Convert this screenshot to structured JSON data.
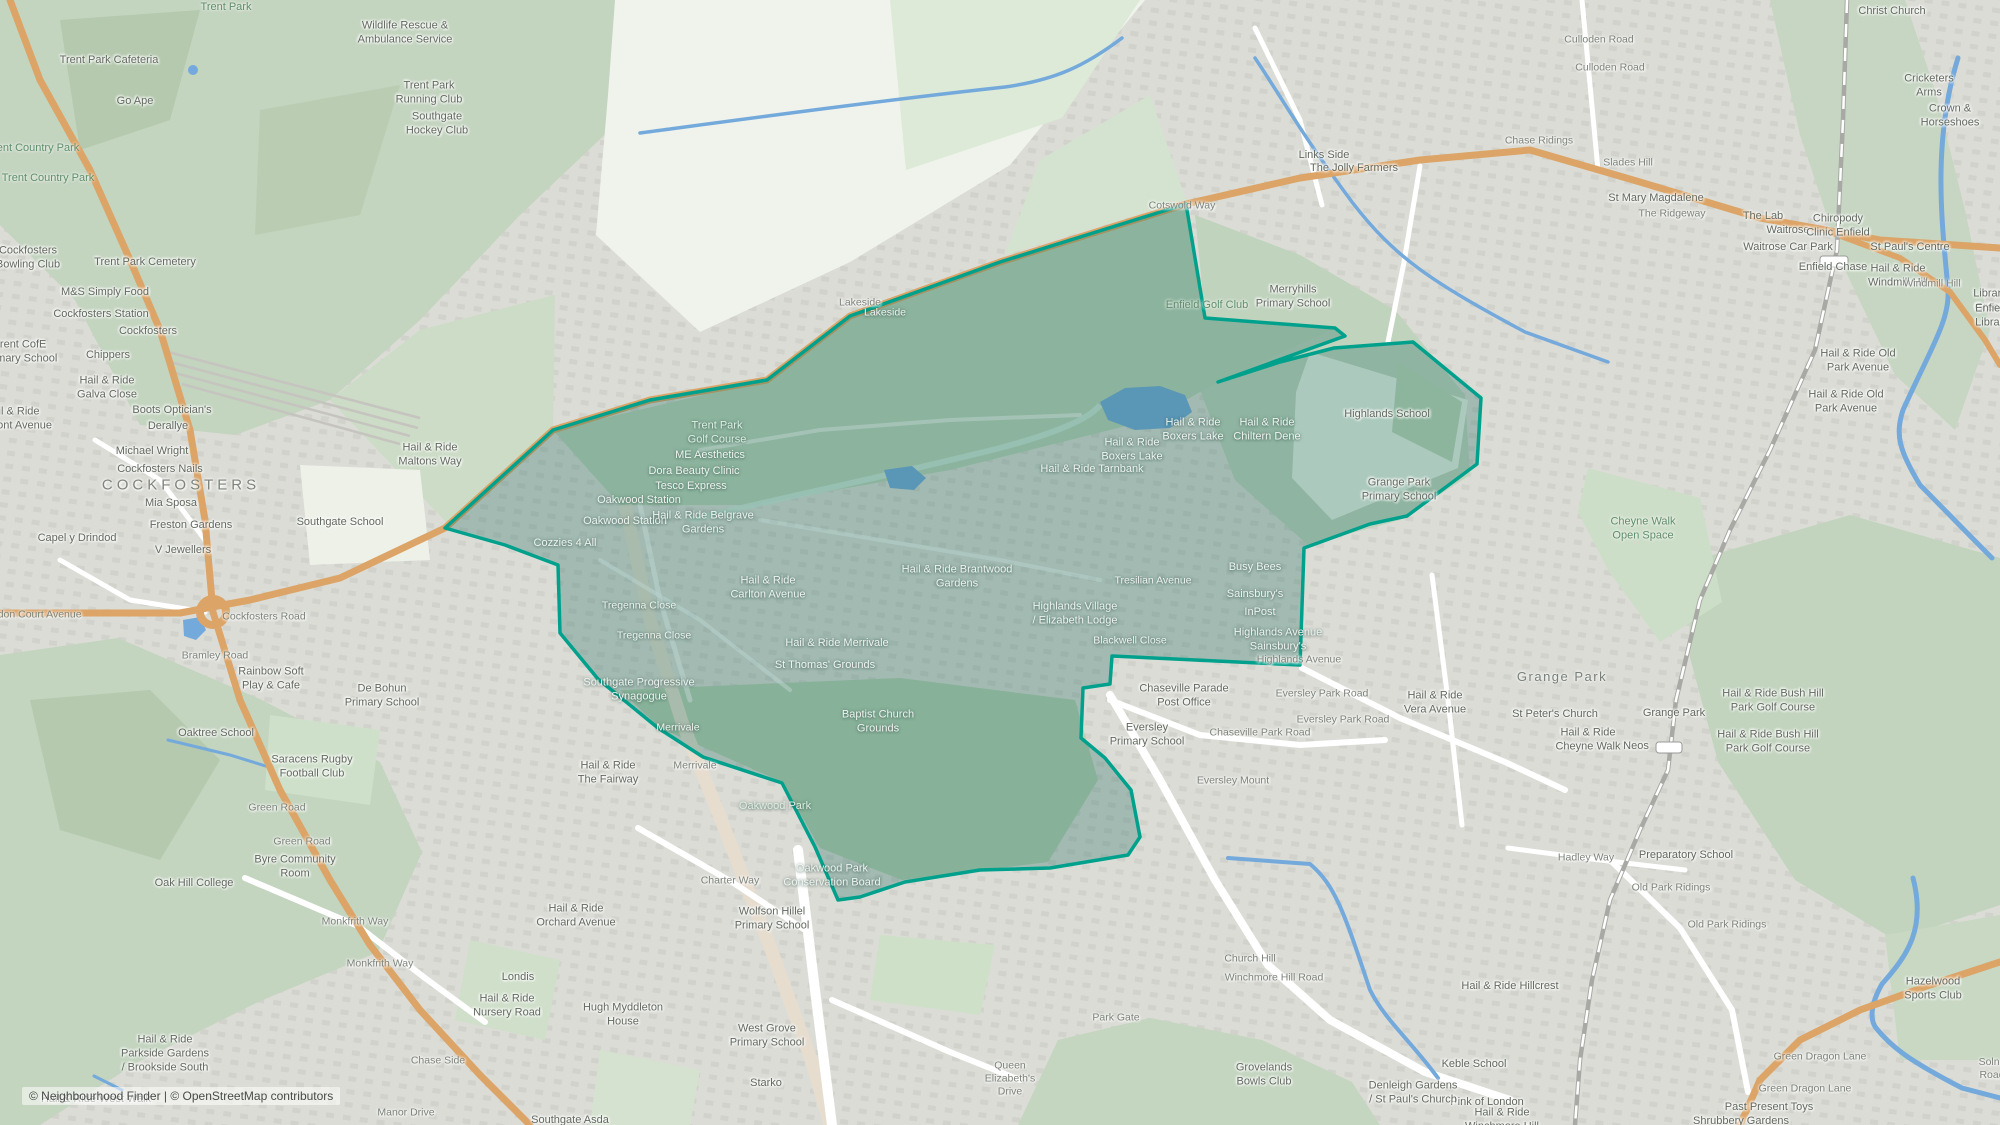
{
  "meta": {
    "width": 2000,
    "height": 1125,
    "attribution": "© Neighbourhood Finder | © OpenStreetMap contributors"
  },
  "colors": {
    "boundary_stroke": "#00a18c",
    "boundary_fill": "rgba(30,110,95,0.30)",
    "residential": "#dbdcd6",
    "park_green": "#c3d4bf",
    "field_light": "#f0f3ec",
    "water_blue": "#74a9dc",
    "road_orange": "#dca466",
    "rail_gray": "#a8a8a4"
  },
  "boundary": {
    "name": "highlighted-neighbourhood-boundary",
    "points": "1186,204 1205,318 1335,328 1345,336 1218,382 1280,362 1334,348 1413,342 1481,398 1477,464 1407,516 1370,524 1304,548 1300,665 1112,656 1110,684 1083,688 1081,738 1105,758 1131,790 1140,837 1128,855 1050,868 980,870 905,882 860,897 838,900 815,847 782,783 703,757 658,728 598,679 560,633 558,565 505,545 445,528 553,430 650,400 767,380 850,316 1000,262"
  },
  "labels": [
    {
      "t": "Trent Park",
      "x": 226,
      "y": 8,
      "c": "k"
    },
    {
      "t": "Wildlife Rescue &\nAmbulance Service",
      "x": 405,
      "y": 33,
      "c": "p"
    },
    {
      "t": "Trent Park Cafeteria",
      "x": 109,
      "y": 61,
      "c": "p"
    },
    {
      "t": "Go Ape",
      "x": 135,
      "y": 102,
      "c": "p"
    },
    {
      "t": "Trent Park\nRunning Club",
      "x": 429,
      "y": 93,
      "c": "p"
    },
    {
      "t": "Southgate\nHockey Club",
      "x": 437,
      "y": 124,
      "c": "p"
    },
    {
      "t": "Trent Country Park",
      "x": 33,
      "y": 149,
      "c": "k"
    },
    {
      "t": "Trent Country Park",
      "x": 48,
      "y": 179,
      "c": "k"
    },
    {
      "t": "Cockfosters\nBowling Club",
      "x": 28,
      "y": 258,
      "c": "p"
    },
    {
      "t": "Trent Park Cemetery",
      "x": 145,
      "y": 263,
      "c": "p"
    },
    {
      "t": "M&S Simply Food",
      "x": 105,
      "y": 293,
      "c": "p"
    },
    {
      "t": "Cockfosters Station",
      "x": 101,
      "y": 315,
      "c": "p"
    },
    {
      "t": "Cockfosters",
      "x": 148,
      "y": 332,
      "c": "p"
    },
    {
      "t": "Trent CofE\nPrimary School",
      "x": 20,
      "y": 352,
      "c": "p"
    },
    {
      "t": "Chippers",
      "x": 108,
      "y": 356,
      "c": "p"
    },
    {
      "t": "Hail & Ride\nGalva Close",
      "x": 107,
      "y": 388,
      "c": "p"
    },
    {
      "t": "Hail & Ride\nBelmont Avenue",
      "x": 12,
      "y": 419,
      "c": "p"
    },
    {
      "t": "Boots Optician's",
      "x": 172,
      "y": 411,
      "c": "p"
    },
    {
      "t": "Derallye",
      "x": 168,
      "y": 427,
      "c": "p"
    },
    {
      "t": "Michael Wright",
      "x": 152,
      "y": 452,
      "c": "p"
    },
    {
      "t": "Cockfosters Nails",
      "x": 160,
      "y": 470,
      "c": "p"
    },
    {
      "t": "COCKFOSTERS",
      "x": 181,
      "y": 486,
      "c": "a"
    },
    {
      "t": "Mia Sposa",
      "x": 171,
      "y": 504,
      "c": "p"
    },
    {
      "t": "Freston Gardens",
      "x": 191,
      "y": 526,
      "c": "p"
    },
    {
      "t": "Capel y Drindod",
      "x": 77,
      "y": 539,
      "c": "p"
    },
    {
      "t": "V Jewellers",
      "x": 183,
      "y": 551,
      "c": "p"
    },
    {
      "t": "Heddon Court Avenue",
      "x": 30,
      "y": 615,
      "c": "r"
    },
    {
      "t": "Cockfosters Road",
      "x": 264,
      "y": 617,
      "c": "r"
    },
    {
      "t": "Bramley Road",
      "x": 215,
      "y": 656,
      "c": "r"
    },
    {
      "t": "Rainbow Soft\nPlay & Cafe",
      "x": 271,
      "y": 679,
      "c": "p"
    },
    {
      "t": "Southgate School",
      "x": 340,
      "y": 523,
      "c": "p"
    },
    {
      "t": "De Bohun\nPrimary School",
      "x": 382,
      "y": 696,
      "c": "p"
    },
    {
      "t": "Oaktree School",
      "x": 216,
      "y": 734,
      "c": "p"
    },
    {
      "t": "Saracens Rugby\nFootball Club",
      "x": 312,
      "y": 767,
      "c": "p"
    },
    {
      "t": "Green Road",
      "x": 277,
      "y": 808,
      "c": "r"
    },
    {
      "t": "Green Road",
      "x": 302,
      "y": 842,
      "c": "r"
    },
    {
      "t": "Byre Community\nRoom",
      "x": 295,
      "y": 867,
      "c": "p"
    },
    {
      "t": "Oak Hill College",
      "x": 194,
      "y": 884,
      "c": "p"
    },
    {
      "t": "Monkfrith Way",
      "x": 355,
      "y": 922,
      "c": "r"
    },
    {
      "t": "Monkfrith Way",
      "x": 380,
      "y": 964,
      "c": "r"
    },
    {
      "t": "Londis",
      "x": 518,
      "y": 978,
      "c": "p"
    },
    {
      "t": "Hail & Ride\nNursery Road",
      "x": 507,
      "y": 1006,
      "c": "p"
    },
    {
      "t": "Chase Side",
      "x": 438,
      "y": 1061,
      "c": "r"
    },
    {
      "t": "Manor Drive",
      "x": 406,
      "y": 1113,
      "c": "r"
    },
    {
      "t": "Hail & Ride\nParkside Gardens\n/ Brookside South",
      "x": 165,
      "y": 1054,
      "c": "p"
    },
    {
      "t": "Hail & Ride West Walk",
      "x": 96,
      "y": 1100,
      "c": "p"
    },
    {
      "t": "Lakeside",
      "x": 860,
      "y": 303,
      "c": "r"
    },
    {
      "t": "Lakeside",
      "x": 885,
      "y": 313,
      "c": "r",
      "l": 1
    },
    {
      "t": "Cotswold Way",
      "x": 1182,
      "y": 206,
      "c": "r"
    },
    {
      "t": "Trent Park\nGolf Course",
      "x": 717,
      "y": 433,
      "c": "k",
      "l": 1
    },
    {
      "t": "ME Aesthetics",
      "x": 710,
      "y": 456,
      "c": "p",
      "l": 1
    },
    {
      "t": "Dora Beauty Clinic",
      "x": 694,
      "y": 472,
      "c": "p",
      "l": 1
    },
    {
      "t": "Tesco Express",
      "x": 691,
      "y": 487,
      "c": "p",
      "l": 1
    },
    {
      "t": "Oakwood Station",
      "x": 639,
      "y": 501,
      "c": "p",
      "l": 1
    },
    {
      "t": "Oakwood Station",
      "x": 625,
      "y": 522,
      "c": "p",
      "l": 1
    },
    {
      "t": "Hail & Ride Belgrave\nGardens",
      "x": 703,
      "y": 523,
      "c": "p",
      "l": 1
    },
    {
      "t": "Cozzies 4 All",
      "x": 565,
      "y": 544,
      "c": "p",
      "l": 1
    },
    {
      "t": "Hail & Ride\nMaltons Way",
      "x": 430,
      "y": 455,
      "c": "p"
    },
    {
      "t": "Tregenna Close",
      "x": 639,
      "y": 606,
      "c": "r",
      "l": 1
    },
    {
      "t": "Tregenna Close",
      "x": 654,
      "y": 636,
      "c": "r",
      "l": 1
    },
    {
      "t": "Hail & Ride\nCarlton Avenue",
      "x": 768,
      "y": 588,
      "c": "p",
      "l": 1
    },
    {
      "t": "Hail & Ride Brantwood\nGardens",
      "x": 957,
      "y": 577,
      "c": "p",
      "l": 1
    },
    {
      "t": "Southgate Progressive\nSynagogue",
      "x": 639,
      "y": 690,
      "c": "p",
      "l": 1
    },
    {
      "t": "Merrivale",
      "x": 678,
      "y": 728,
      "c": "r",
      "l": 1
    },
    {
      "t": "Merrivale",
      "x": 695,
      "y": 766,
      "c": "r"
    },
    {
      "t": "Hail & Ride\nThe Fairway",
      "x": 608,
      "y": 773,
      "c": "p"
    },
    {
      "t": "Hail & Ride Merrivale",
      "x": 837,
      "y": 644,
      "c": "p",
      "l": 1
    },
    {
      "t": "St Thomas' Grounds",
      "x": 825,
      "y": 666,
      "c": "p",
      "l": 1
    },
    {
      "t": "Baptist Church\nGrounds",
      "x": 878,
      "y": 722,
      "c": "p",
      "l": 1
    },
    {
      "t": "Oakwood Park",
      "x": 775,
      "y": 807,
      "c": "k",
      "l": 1
    },
    {
      "t": "Charter Way",
      "x": 730,
      "y": 881,
      "c": "r"
    },
    {
      "t": "Oakwood Park\nConservation Board",
      "x": 832,
      "y": 876,
      "c": "p",
      "l": 1
    },
    {
      "t": "Hail & Ride\nOrchard Avenue",
      "x": 576,
      "y": 916,
      "c": "p"
    },
    {
      "t": "Wolfson Hillel\nPrimary School",
      "x": 772,
      "y": 919,
      "c": "p"
    },
    {
      "t": "Hugh Myddleton\nHouse",
      "x": 623,
      "y": 1015,
      "c": "p"
    },
    {
      "t": "West Grove\nPrimary School",
      "x": 767,
      "y": 1036,
      "c": "p"
    },
    {
      "t": "Starko",
      "x": 766,
      "y": 1084,
      "c": "p"
    },
    {
      "t": "Southgate Asda",
      "x": 570,
      "y": 1121,
      "c": "p"
    },
    {
      "t": "Merryhills\nPrimary School",
      "x": 1293,
      "y": 297,
      "c": "p"
    },
    {
      "t": "Links Side",
      "x": 1324,
      "y": 156,
      "c": "p"
    },
    {
      "t": "The Jolly Farmers",
      "x": 1354,
      "y": 169,
      "c": "p"
    },
    {
      "t": "Enfield Golf Club",
      "x": 1207,
      "y": 306,
      "c": "k"
    },
    {
      "t": "Hail & Ride\nBoxers Lake",
      "x": 1193,
      "y": 430,
      "c": "p",
      "l": 1
    },
    {
      "t": "Hail & Ride\nBoxers Lake",
      "x": 1132,
      "y": 450,
      "c": "p",
      "l": 1
    },
    {
      "t": "Hail & Ride Tarnbank",
      "x": 1092,
      "y": 470,
      "c": "p",
      "l": 1
    },
    {
      "t": "Hail & Ride\nChiltern Dene",
      "x": 1267,
      "y": 430,
      "c": "p",
      "l": 1
    },
    {
      "t": "Highlands School",
      "x": 1387,
      "y": 415,
      "c": "p"
    },
    {
      "t": "Grange Park\nPrimary School",
      "x": 1399,
      "y": 490,
      "c": "p"
    },
    {
      "t": "Busy Bees",
      "x": 1255,
      "y": 568,
      "c": "p",
      "l": 1
    },
    {
      "t": "Sainsbury's",
      "x": 1255,
      "y": 595,
      "c": "p",
      "l": 1
    },
    {
      "t": "InPost",
      "x": 1260,
      "y": 613,
      "c": "p",
      "l": 1
    },
    {
      "t": "Highlands Avenue\nSainsbury's",
      "x": 1278,
      "y": 640,
      "c": "p",
      "l": 1
    },
    {
      "t": "Highlands Avenue",
      "x": 1299,
      "y": 660,
      "c": "r"
    },
    {
      "t": "Tresilian Avenue",
      "x": 1153,
      "y": 581,
      "c": "r",
      "l": 1
    },
    {
      "t": "Highlands Village\n/ Elizabeth Lodge",
      "x": 1075,
      "y": 614,
      "c": "p",
      "l": 1
    },
    {
      "t": "Blackwell Close",
      "x": 1130,
      "y": 641,
      "c": "r",
      "l": 1
    },
    {
      "t": "Chaseville Parade\nPost Office",
      "x": 1184,
      "y": 696,
      "c": "p"
    },
    {
      "t": "Eversley\nPrimary School",
      "x": 1147,
      "y": 735,
      "c": "p"
    },
    {
      "t": "Eversley Park Road",
      "x": 1322,
      "y": 694,
      "c": "r"
    },
    {
      "t": "Eversley Park Road",
      "x": 1343,
      "y": 720,
      "c": "r"
    },
    {
      "t": "Chaseville Park Road",
      "x": 1260,
      "y": 733,
      "c": "r"
    },
    {
      "t": "Eversley Mount",
      "x": 1233,
      "y": 781,
      "c": "r"
    },
    {
      "t": "Hail & Ride\nVera Avenue",
      "x": 1435,
      "y": 703,
      "c": "p"
    },
    {
      "t": "Culloden Road",
      "x": 1599,
      "y": 40,
      "c": "r"
    },
    {
      "t": "Culloden Road",
      "x": 1610,
      "y": 68,
      "c": "r"
    },
    {
      "t": "Chase Ridings",
      "x": 1539,
      "y": 141,
      "c": "r"
    },
    {
      "t": "Slades Hill",
      "x": 1628,
      "y": 163,
      "c": "r"
    },
    {
      "t": "St Mary Magdalene",
      "x": 1656,
      "y": 199,
      "c": "p"
    },
    {
      "t": "The Ridgeway",
      "x": 1672,
      "y": 214,
      "c": "r"
    },
    {
      "t": "The Lab",
      "x": 1763,
      "y": 217,
      "c": "p"
    },
    {
      "t": "Waitrose",
      "x": 1788,
      "y": 231,
      "c": "p"
    },
    {
      "t": "Chiropody\nClinic Enfield",
      "x": 1838,
      "y": 226,
      "c": "p"
    },
    {
      "t": "Waitrose Car Park",
      "x": 1788,
      "y": 248,
      "c": "p"
    },
    {
      "t": "Enfield Chase",
      "x": 1833,
      "y": 268,
      "c": "p"
    },
    {
      "t": "Christ Church",
      "x": 1892,
      "y": 12,
      "c": "p"
    },
    {
      "t": "Cricketers Arms",
      "x": 1929,
      "y": 86,
      "c": "p"
    },
    {
      "t": "Crown & Horseshoes",
      "x": 1950,
      "y": 116,
      "c": "p"
    },
    {
      "t": "St Paul's Centre",
      "x": 1910,
      "y": 248,
      "c": "p"
    },
    {
      "t": "Hail & Ride\nWindmill Hill",
      "x": 1898,
      "y": 276,
      "c": "p"
    },
    {
      "t": "Windmill Hill",
      "x": 1932,
      "y": 284,
      "c": "r"
    },
    {
      "t": "Library Green",
      "x": 1990,
      "y": 301,
      "c": "p"
    },
    {
      "t": "Enfield Library",
      "x": 1992,
      "y": 316,
      "c": "p"
    },
    {
      "t": "Hail & Ride Old\nPark Avenue",
      "x": 1858,
      "y": 361,
      "c": "p"
    },
    {
      "t": "Hail & Ride Old\nPark Avenue",
      "x": 1846,
      "y": 402,
      "c": "p"
    },
    {
      "t": "Cheyne Walk\nOpen Space",
      "x": 1643,
      "y": 529,
      "c": "k"
    },
    {
      "t": "Grange Park",
      "x": 1562,
      "y": 677,
      "c": "a2"
    },
    {
      "t": "St Peter's Church",
      "x": 1555,
      "y": 715,
      "c": "p"
    },
    {
      "t": "Hail & Ride\nCheyne Walk",
      "x": 1588,
      "y": 740,
      "c": "p"
    },
    {
      "t": "Neos",
      "x": 1636,
      "y": 747,
      "c": "p"
    },
    {
      "t": "Grange Park",
      "x": 1674,
      "y": 714,
      "c": "p"
    },
    {
      "t": "Hail & Ride Bush Hill\nPark Golf Course",
      "x": 1773,
      "y": 701,
      "c": "p"
    },
    {
      "t": "Hail & Ride Bush Hill\nPark Golf Course",
      "x": 1768,
      "y": 742,
      "c": "p"
    },
    {
      "t": "Hadley Way",
      "x": 1586,
      "y": 858,
      "c": "r"
    },
    {
      "t": "Preparatory School",
      "x": 1686,
      "y": 856,
      "c": "p"
    },
    {
      "t": "Old Park Ridings",
      "x": 1671,
      "y": 888,
      "c": "r"
    },
    {
      "t": "Old Park Ridings",
      "x": 1727,
      "y": 925,
      "c": "r"
    },
    {
      "t": "Hail & Ride Hillcrest",
      "x": 1510,
      "y": 987,
      "c": "p"
    },
    {
      "t": "Keble School",
      "x": 1474,
      "y": 1065,
      "c": "p"
    },
    {
      "t": "Pink of London",
      "x": 1487,
      "y": 1103,
      "c": "p"
    },
    {
      "t": "Hail & Ride\nWinchmore Hill",
      "x": 1502,
      "y": 1120,
      "c": "p"
    },
    {
      "t": "Green Dragon Lane",
      "x": 1820,
      "y": 1057,
      "c": "r"
    },
    {
      "t": "Green Dragon Lane",
      "x": 1805,
      "y": 1089,
      "c": "r"
    },
    {
      "t": "Past Present Toys",
      "x": 1769,
      "y": 1108,
      "c": "p"
    },
    {
      "t": "Shrubbery Gardens",
      "x": 1741,
      "y": 1122,
      "c": "p"
    },
    {
      "t": "Hazelwood\nSports Club",
      "x": 1933,
      "y": 989,
      "c": "p"
    },
    {
      "t": "Solna Road",
      "x": 1992,
      "y": 1069,
      "c": "r"
    },
    {
      "t": "Church Hill",
      "x": 1250,
      "y": 959,
      "c": "r"
    },
    {
      "t": "Winchmore Hill Road",
      "x": 1274,
      "y": 978,
      "c": "r"
    },
    {
      "t": "Park Gate",
      "x": 1116,
      "y": 1018,
      "c": "r"
    },
    {
      "t": "Queen\nElizabeth's\nDrive",
      "x": 1010,
      "y": 1079,
      "c": "r"
    },
    {
      "t": "Grovelands\nBowls Club",
      "x": 1264,
      "y": 1075,
      "c": "p"
    },
    {
      "t": "Denleigh Gardens\n/ St Paul's Church",
      "x": 1413,
      "y": 1093,
      "c": "p"
    }
  ]
}
